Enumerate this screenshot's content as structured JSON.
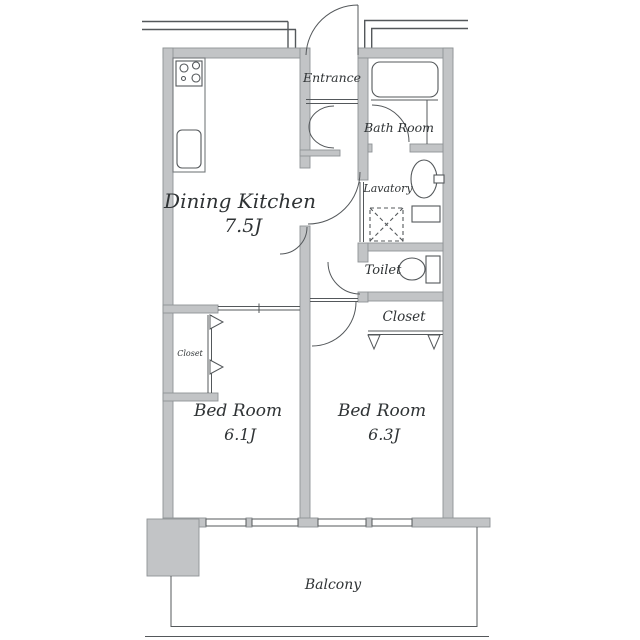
{
  "floorplan": {
    "title": "Apartment floor plan",
    "rooms": {
      "dining_kitchen": {
        "name": "Dining Kitchen",
        "size": "7.5J"
      },
      "entrance": {
        "name": "Entrance"
      },
      "bath": {
        "name": "Bath Room"
      },
      "lavatory": {
        "name": "Lavatory"
      },
      "toilet": {
        "name": "Toilet"
      },
      "closet_right": {
        "name": "Closet"
      },
      "closet_left": {
        "name": "Closet"
      },
      "bedroom_left": {
        "name": "Bed Room",
        "size": "6.1J"
      },
      "bedroom_right": {
        "name": "Bed Room",
        "size": "6.3J"
      },
      "balcony": {
        "name": "Balcony"
      }
    },
    "colors": {
      "background": "#ffffff",
      "wall_fill": "#c2c4c6",
      "wall_stroke": "#8f9396",
      "thin_line": "#54585b",
      "text": "#2f3335"
    }
  }
}
